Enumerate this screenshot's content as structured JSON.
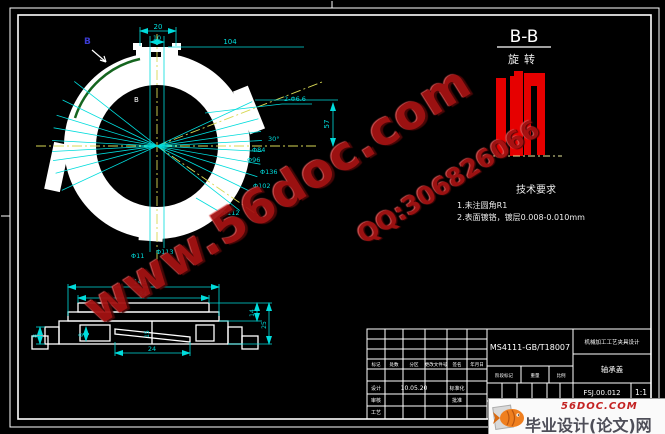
{
  "ring_view": {
    "dims": {
      "d20": "20",
      "d10": "10",
      "d104": "104",
      "d57": "57",
      "a30": "30°",
      "holes": "2-Φ6.6",
      "dia84": "Φ84",
      "dia96": "Φ96",
      "dia136": "Φ136",
      "dia102": "Φ102",
      "dia112": "Φ112",
      "dia11": "Φ11",
      "dia113": "Φ113"
    },
    "section_label_outer": "B",
    "section_label_inner": "B"
  },
  "side_view": {
    "dims": {
      "d148": "148",
      "d84": "84",
      "d24": "24",
      "d25": "25",
      "d14": "14",
      "d8a": "8",
      "d8b": "8",
      "d15": "15"
    }
  },
  "section_view": {
    "title": "B-B",
    "subtitle": "旋转"
  },
  "tech_req": {
    "title": "技术要求",
    "items": [
      "1.未注圆角R1",
      "2.表面镀铬，镀层0.008-0.010mm"
    ]
  },
  "title_block": {
    "material": "MS4111-GB/T18007",
    "project": "机械加工工艺夹具设计",
    "part_name": "轴承盖",
    "drawing_no": "FSJ.00.012",
    "scale": "1:1",
    "date": "10.05.20",
    "rev_headers": [
      "标记",
      "处数",
      "分区",
      "更改文件号",
      "签名",
      "年月日"
    ],
    "role_labels": [
      "设计",
      "审核",
      "工艺",
      "标准化",
      "批准"
    ],
    "stage_labels": [
      "阶段标记",
      "重量",
      "比例"
    ]
  },
  "watermark": {
    "site": "www.56doc.com",
    "qq": "QQ:306826066"
  },
  "banner": {
    "domain": "56DOC.COM",
    "name": "毕业设计(论文)网"
  },
  "colors": {
    "line": "#ffffff",
    "dim": "#00dcdc",
    "center": "#d8d855",
    "section_fill": "#e60000",
    "watermark": "#a41212",
    "green_arc": "#15651f",
    "b_label": "#3b3bd0"
  }
}
